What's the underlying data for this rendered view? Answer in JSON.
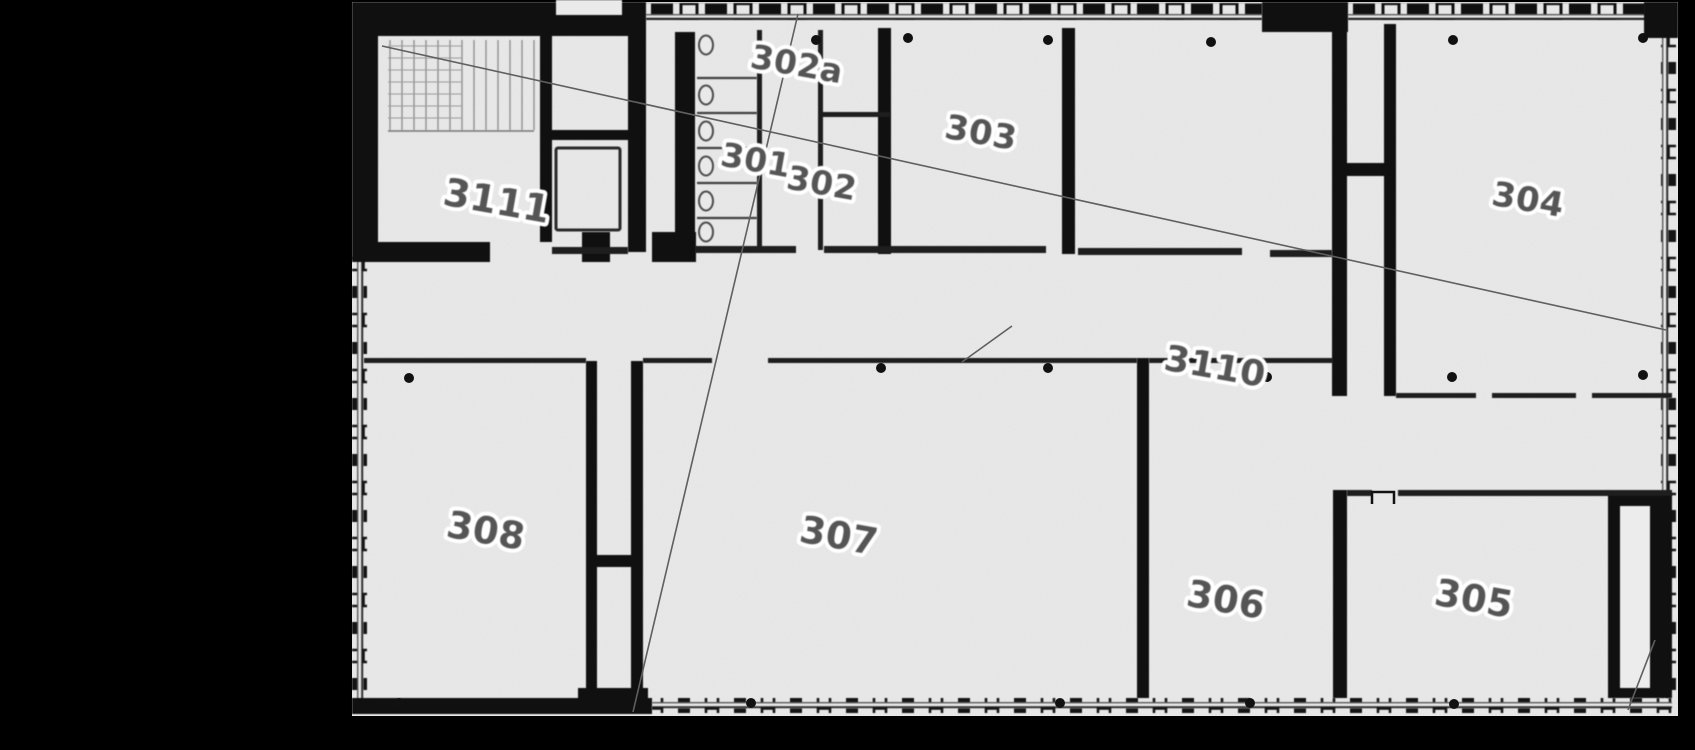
{
  "image": {
    "kind": "scanned architectural floor plan",
    "background_color": "#000000",
    "floor_color": "#eaeaea",
    "wall_color": "#101010",
    "label_color": "#555555",
    "label_halo_color": "#ffffff"
  },
  "rooms": [
    {
      "label": "3111"
    },
    {
      "label": "302a"
    },
    {
      "label": "301"
    },
    {
      "label": "302"
    },
    {
      "label": "303"
    },
    {
      "label": "304"
    },
    {
      "label": "3110"
    },
    {
      "label": "308"
    },
    {
      "label": "307"
    },
    {
      "label": "306"
    },
    {
      "label": "305"
    }
  ]
}
